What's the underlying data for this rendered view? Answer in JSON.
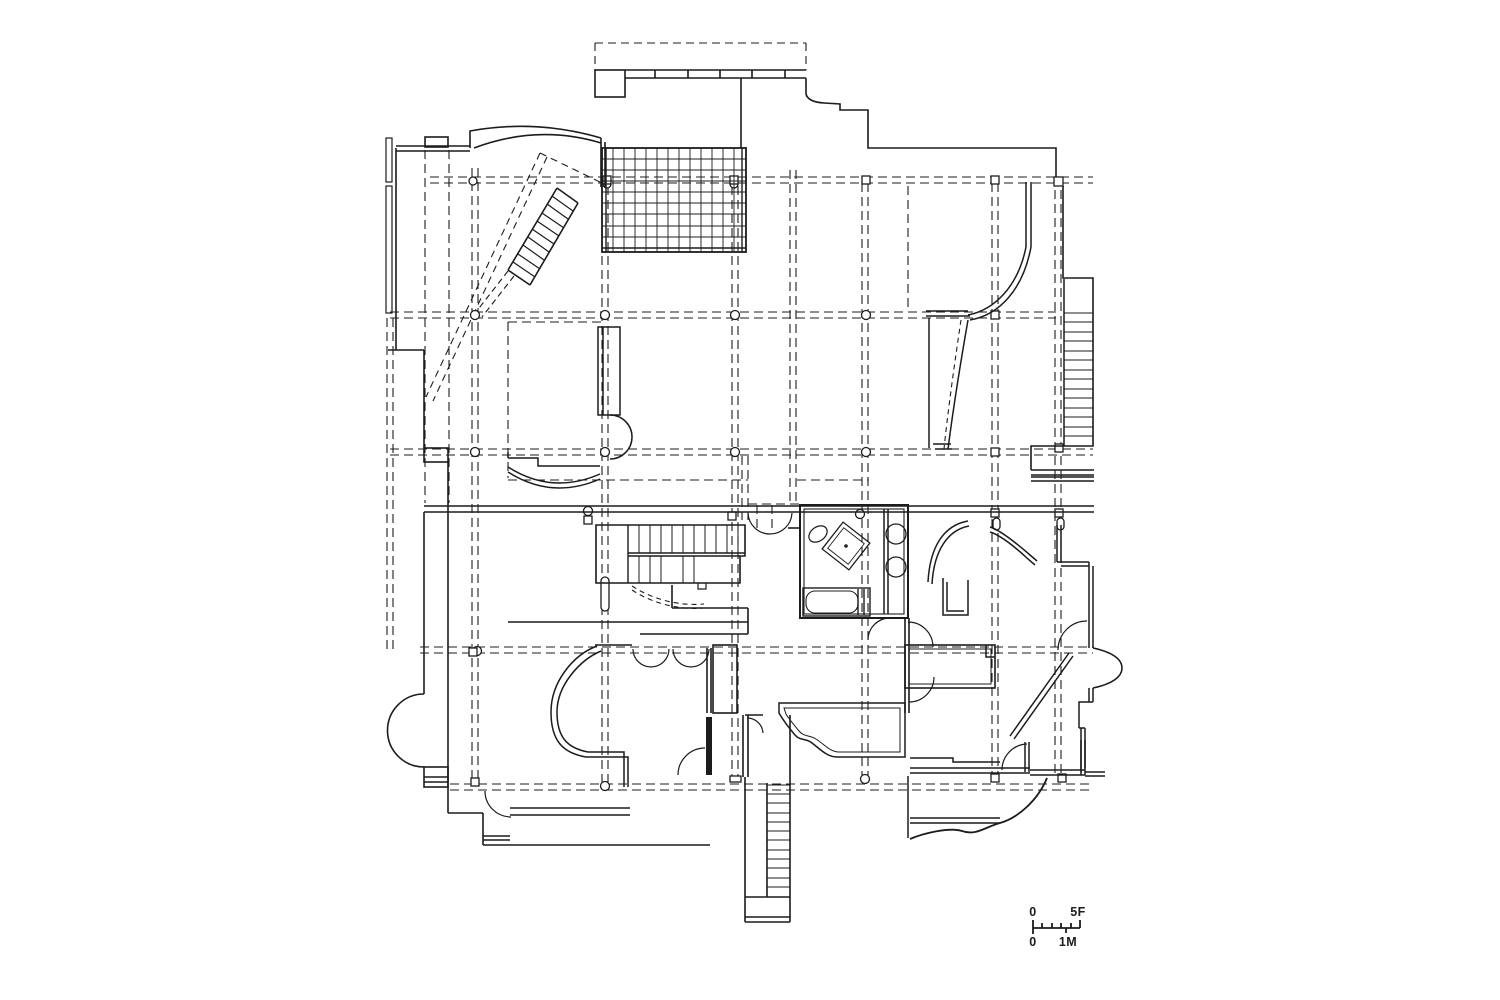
{
  "page": {
    "background_color": "#ffffff",
    "ink_color": "#1c1c1c"
  },
  "scale_bar": {
    "feet_zero_label": "0",
    "feet_max_label": "5F",
    "meters_zero_label": "0",
    "meters_max_label": "1M"
  }
}
